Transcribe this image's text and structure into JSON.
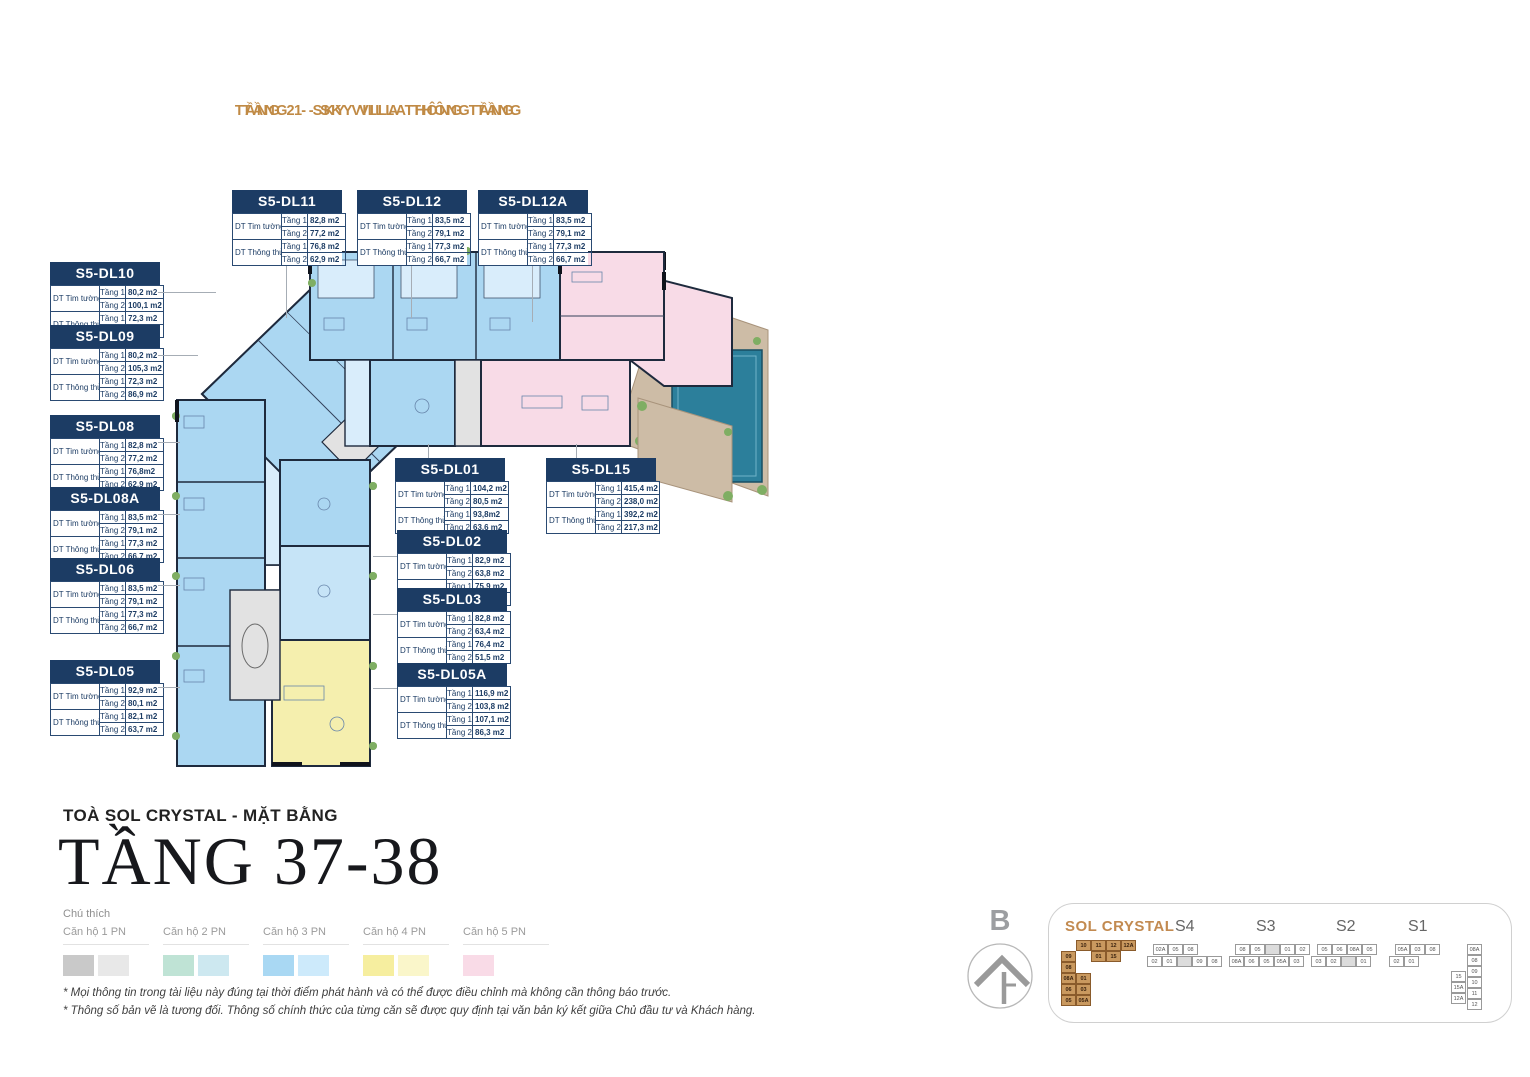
{
  "headers": {
    "tang1": "TẦNG 1 - SKY VILLA THÔNG TẦNG",
    "tang2": "TẦNG 2 - SKY VILLA THÔNG TẦNG"
  },
  "table_labels": {
    "tim": "DT Tim tường",
    "thong": "DT Thông thủy",
    "floor1": "Tầng 1",
    "floor2": "Tầng 2"
  },
  "units": [
    {
      "id": "S5-DL11",
      "tim": [
        "82,8 m2",
        "77,2 m2"
      ],
      "thong": [
        "76,8 m2",
        "62,9 m2"
      ]
    },
    {
      "id": "S5-DL12",
      "tim": [
        "83,5 m2",
        "79,1 m2"
      ],
      "thong": [
        "77,3 m2",
        "66,7 m2"
      ]
    },
    {
      "id": "S5-DL12A",
      "tim": [
        "83,5 m2",
        "79,1 m2"
      ],
      "thong": [
        "77,3 m2",
        "66,7 m2"
      ]
    },
    {
      "id": "S5-DL10",
      "tim": [
        "80,2 m2",
        "100,1 m2"
      ],
      "thong": [
        "72,3 m2",
        "81,0 m2"
      ]
    },
    {
      "id": "S5-DL09",
      "tim": [
        "80,2 m2",
        "105,3 m2"
      ],
      "thong": [
        "72,3 m2",
        "86,9 m2"
      ]
    },
    {
      "id": "S5-DL08",
      "tim": [
        "82,8 m2",
        "77,2 m2"
      ],
      "thong": [
        "76,8m2",
        "62,9 m2"
      ]
    },
    {
      "id": "S5-DL08A",
      "tim": [
        "83,5 m2",
        "79,1 m2"
      ],
      "thong": [
        "77,3 m2",
        "66,7 m2"
      ]
    },
    {
      "id": "S5-DL06",
      "tim": [
        "83,5 m2",
        "79,1 m2"
      ],
      "thong": [
        "77,3 m2",
        "66,7 m2"
      ]
    },
    {
      "id": "S5-DL05",
      "tim": [
        "92,9 m2",
        "80,1 m2"
      ],
      "thong": [
        "82,1 m2",
        "63,7 m2"
      ]
    },
    {
      "id": "S5-DL01",
      "tim": [
        "104,2 m2",
        "80,5 m2"
      ],
      "thong": [
        "93,8m2",
        "63,6 m2"
      ]
    },
    {
      "id": "S5-DL15",
      "tim": [
        "415,4 m2",
        "238,0 m2"
      ],
      "thong": [
        "392,2 m2",
        "217,3 m2"
      ]
    },
    {
      "id": "S5-DL02",
      "tim": [
        "82,9 m2",
        "63,8 m2"
      ],
      "thong": [
        "75,9 m2",
        "51,2 m2"
      ]
    },
    {
      "id": "S5-DL03",
      "tim": [
        "82,8 m2",
        "63,4 m2"
      ],
      "thong": [
        "76,4 m2",
        "51,5 m2"
      ]
    },
    {
      "id": "S5-DL05A",
      "tim": [
        "116,9 m2",
        "103,8 m2"
      ],
      "thong": [
        "107,1 m2",
        "86,3 m2"
      ]
    }
  ],
  "title_block": {
    "subtitle": "TOÀ SOL CRYSTAL - MẶT BẰNG",
    "title": "TẦNG 37-38"
  },
  "legend": {
    "heading": "Chú thích",
    "items": [
      {
        "label": "Căn hộ 1 PN",
        "colors": [
          "#c9c9c9",
          "#e8e8e8"
        ]
      },
      {
        "label": "Căn hộ 2 PN",
        "colors": [
          "#bfe3d5",
          "#cde8f0"
        ]
      },
      {
        "label": "Căn hộ 3 PN",
        "colors": [
          "#a9d8f3",
          "#cdeafb"
        ]
      },
      {
        "label": "Căn hộ 4 PN",
        "colors": [
          "#f6ee9f",
          "#faf6ca"
        ]
      },
      {
        "label": "Căn hộ 5 PN",
        "colors": [
          "#f9dbe7"
        ]
      }
    ]
  },
  "notes": [
    "* Mọi thông tin trong tài liệu này đúng tại thời điểm phát hành và có thể được điều chỉnh mà không cần thông báo trước.",
    "* Thông số bản vẽ là tương đối. Thông số chính thức của từng căn sẽ được quy định tại văn bản ký kết giữa Chủ đầu tư và Khách hàng."
  ],
  "compass": {
    "label": "B"
  },
  "minimap": {
    "building": "SOL CRYSTAL",
    "tower_names": [
      "S4",
      "S3",
      "S2",
      "S1"
    ],
    "sol_cells": [
      {
        "t": "10",
        "x": 1,
        "y": 0
      },
      {
        "t": "11",
        "x": 2,
        "y": 0
      },
      {
        "t": "12",
        "x": 3,
        "y": 0
      },
      {
        "t": "12A",
        "x": 4,
        "y": 0
      },
      {
        "t": "09",
        "x": 0,
        "y": 1
      },
      {
        "t": "01",
        "x": 2,
        "y": 1
      },
      {
        "t": "15",
        "x": 3,
        "y": 1
      },
      {
        "t": "08",
        "x": 0,
        "y": 2
      },
      {
        "t": "08A",
        "x": 0,
        "y": 3
      },
      {
        "t": "06",
        "x": 0,
        "y": 4
      },
      {
        "t": "05",
        "x": 0,
        "y": 5
      },
      {
        "t": "01",
        "x": 1,
        "y": 3
      },
      {
        "t": "03",
        "x": 1,
        "y": 4
      },
      {
        "t": "05A",
        "x": 1,
        "y": 5
      }
    ],
    "towers": [
      {
        "name": "S4",
        "top": [
          "02A",
          "05",
          "08"
        ],
        "bottom": [
          "02",
          "01",
          "",
          "09",
          "08"
        ]
      },
      {
        "name": "S3",
        "top": [
          "08",
          "05",
          "",
          "01",
          "02"
        ],
        "bottom": [
          "08A",
          "06",
          "05",
          "05A",
          "03"
        ]
      },
      {
        "name": "S2",
        "top": [
          "05",
          "06",
          "08A",
          "05"
        ],
        "bottom": [
          "03",
          "02",
          "",
          "01"
        ]
      },
      {
        "name": "S1",
        "top": [
          "05A",
          "03",
          "08"
        ],
        "bottom": [
          "02",
          "01"
        ],
        "right_col": [
          "08A",
          "08",
          "09",
          "10",
          "11",
          "12"
        ],
        "mid_col": [
          "15",
          "15A",
          "12A"
        ]
      }
    ]
  },
  "colors": {
    "accent_orange": "#c08a45",
    "navy": "#1c3c64",
    "plan_blue": "#abd7f2",
    "plan_blue_light": "#d9edfb",
    "plan_pink": "#f8dbe7",
    "plan_yellow": "#f5efae",
    "plan_gray": "#e2e2e2",
    "deck_tan": "#cdbca6",
    "pool_teal": "#2c7f9b",
    "green": "#7fae63"
  }
}
